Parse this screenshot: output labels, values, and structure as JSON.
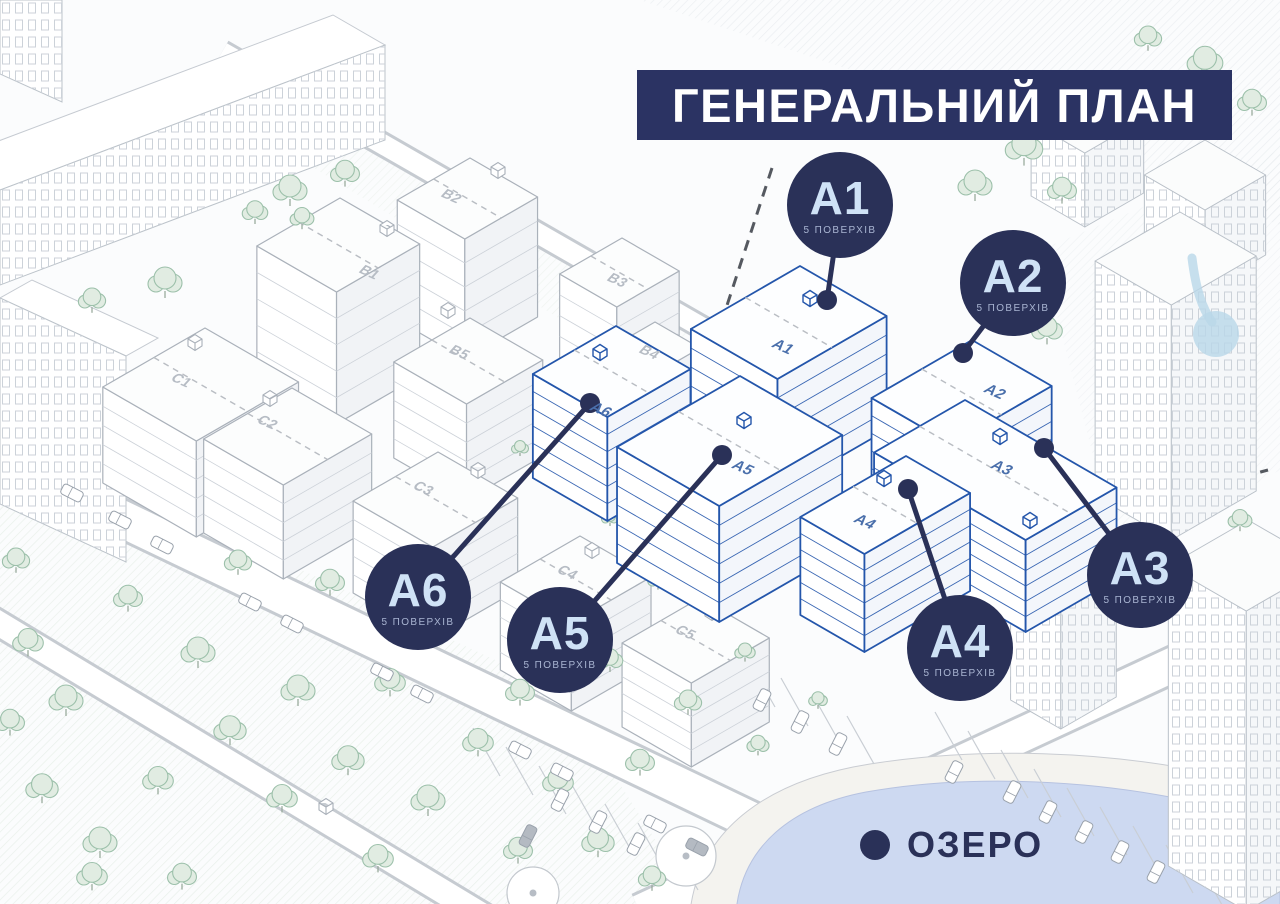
{
  "header": {
    "title": "ГЕНЕРАЛЬНИЙ ПЛАН"
  },
  "badges": {
    "a1": {
      "label": "A1",
      "floors": "5 ПОВЕРХІВ"
    },
    "a2": {
      "label": "A2",
      "floors": "5 ПОВЕРХІВ"
    },
    "a3": {
      "label": "A3",
      "floors": "5 ПОВЕРХІВ"
    },
    "a4": {
      "label": "A4",
      "floors": "5 ПОВЕРХІВ"
    },
    "a5": {
      "label": "A5",
      "floors": "5 ПОВЕРХІВ"
    },
    "a6": {
      "label": "A6",
      "floors": "5 ПОВЕРХІВ"
    }
  },
  "roof_labels": {
    "a1": "A1",
    "a2": "A2",
    "a3": "A3",
    "a4": "A4",
    "a5": "A5",
    "a6": "A6"
  },
  "context_labels": {
    "b1": "B1",
    "b2": "B2",
    "b3": "B3",
    "b4": "B4",
    "b5": "B5",
    "c1": "C1",
    "c2": "C2",
    "c3": "C3",
    "c4": "C4",
    "c5": "C5"
  },
  "lake": {
    "label": "ОЗЕРО"
  },
  "colors": {
    "navy": "#2a3158",
    "banner": "#2b3363",
    "badge_text": "#cfe2f6",
    "badge_subtext": "#a9b5d2",
    "accent_blue": "#2456ab",
    "lake": "#cdd9f1",
    "tree": "#9cc0aa",
    "line_gray": "#aab1ba"
  }
}
